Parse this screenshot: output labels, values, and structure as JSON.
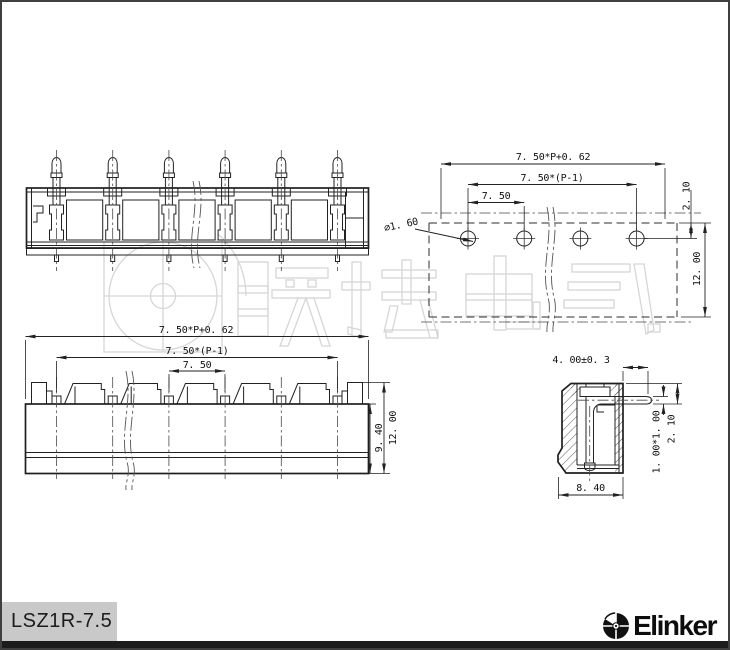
{
  "product": {
    "model": "LSZ1R-7.5",
    "brand": "Elinker"
  },
  "watermark": {
    "text": "联捷电气"
  },
  "views": {
    "drill_plan": {
      "dims": {
        "overall": "7. 50*P+0. 62",
        "span": "7. 50*(P-1)",
        "pitch": "7. 50",
        "hole_dia": "∅1. 60",
        "edge_to_hole": "2. 10",
        "height": "12. 00"
      }
    },
    "front": {
      "dims": {
        "overall": "7. 50*P+0. 62",
        "span": "7. 50*(P-1)",
        "pitch": "7. 50",
        "body_height": "9. 40",
        "total_height": "12. 00"
      }
    },
    "profile": {
      "dims": {
        "pin_length": "4. 00±0. 3",
        "depth": "8. 40",
        "pin_section": "1. 00*1. 00",
        "pin_offset": "2. 10"
      }
    }
  }
}
